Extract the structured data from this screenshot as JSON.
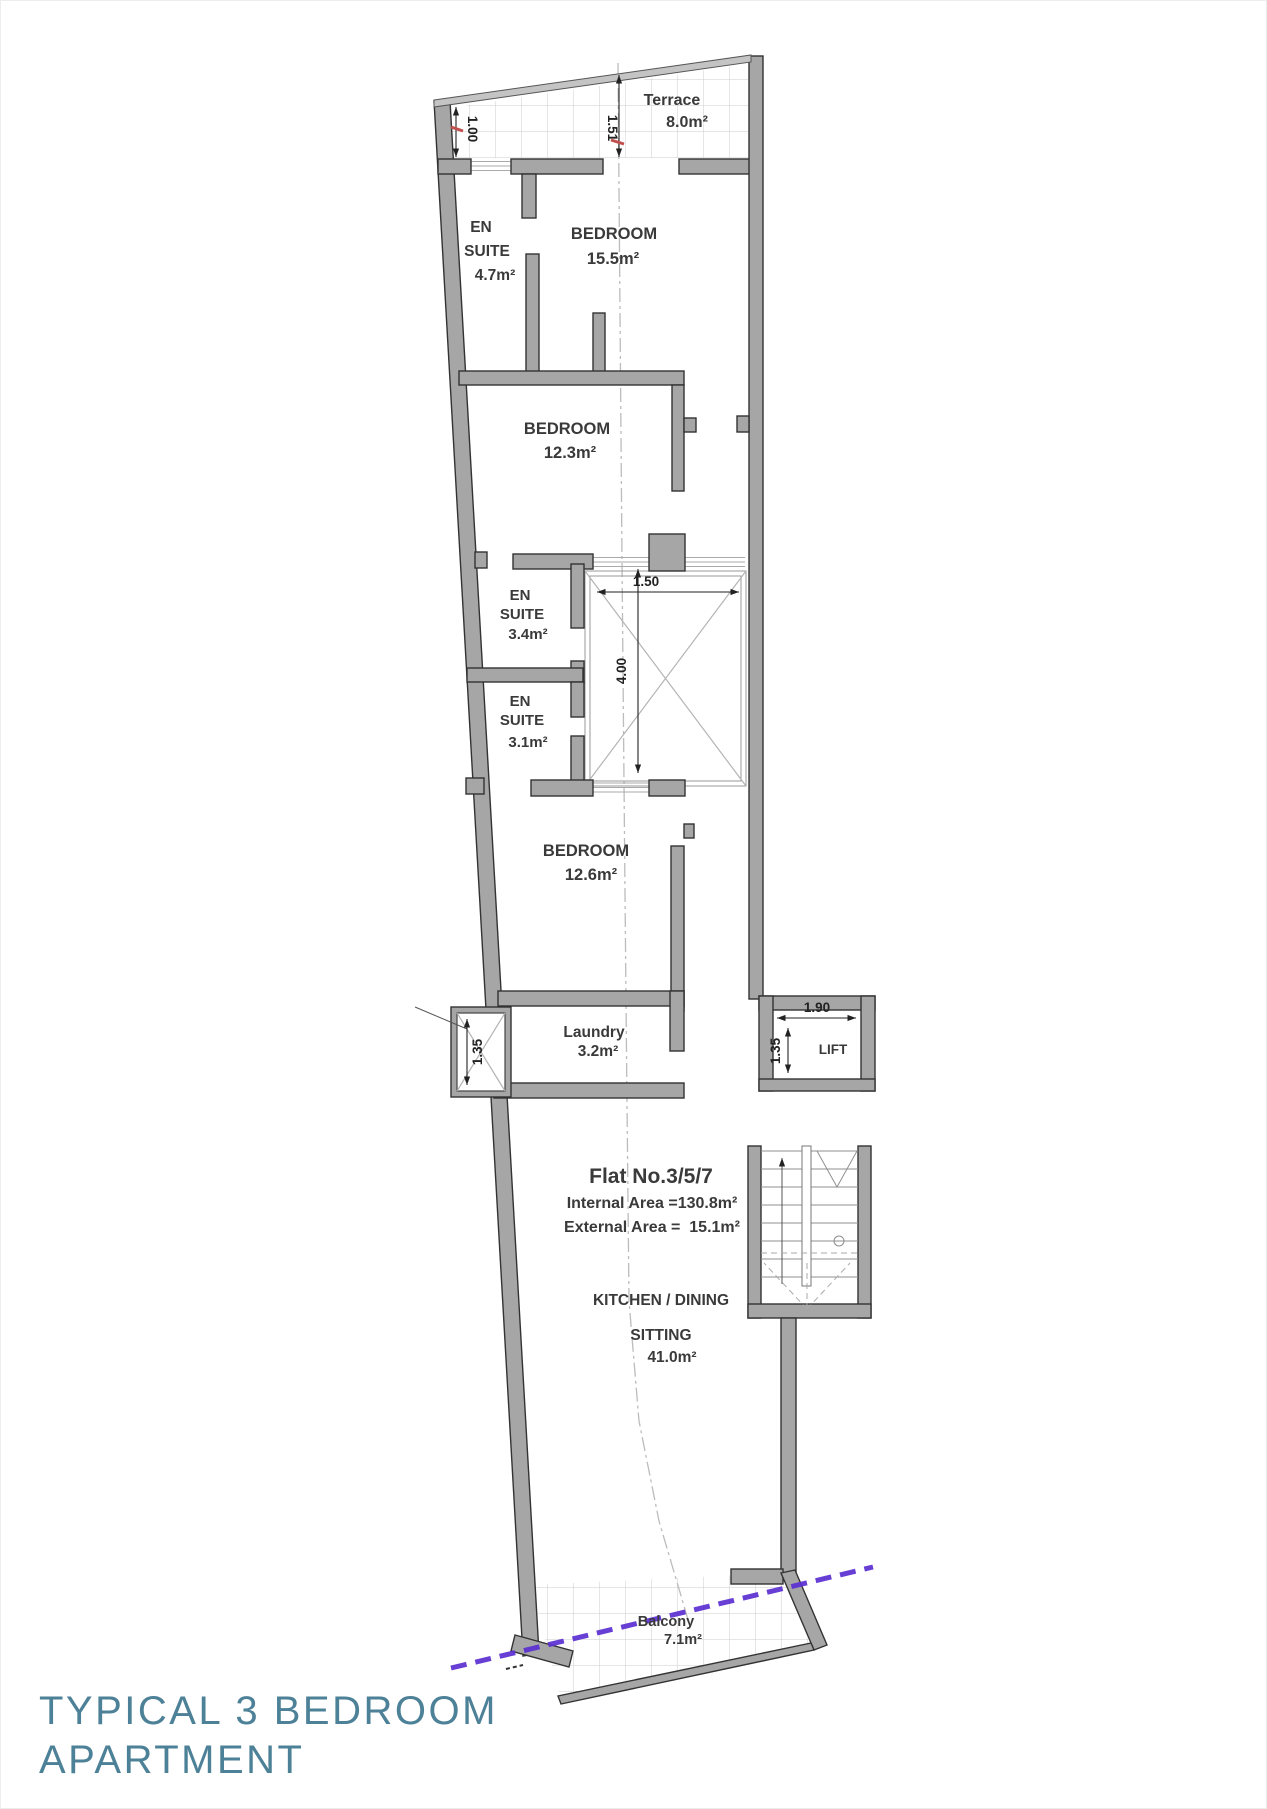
{
  "page": {
    "title_line1": "TYPICAL 3 BEDROOM",
    "title_line2": "APARTMENT"
  },
  "plan": {
    "flat": {
      "name": "Flat No.3/5/7",
      "internal": "Internal Area =130.8m²",
      "external": "External Area =  15.1m²"
    },
    "rooms": {
      "terrace": {
        "name": "Terrace",
        "area": "8.0m²"
      },
      "ensuite_1": {
        "l1": "EN",
        "l2": "SUITE",
        "area": "4.7m²"
      },
      "bedroom_1": {
        "name": "BEDROOM",
        "area": "15.5m²"
      },
      "bedroom_2": {
        "name": "BEDROOM",
        "area": "12.3m²"
      },
      "ensuite_2": {
        "l1": "EN",
        "l2": "SUITE",
        "area": "3.4m²"
      },
      "ensuite_3": {
        "l1": "EN",
        "l2": "SUITE",
        "area": "3.1m²"
      },
      "bedroom_3": {
        "name": "BEDROOM",
        "area": "12.6m²"
      },
      "laundry": {
        "name": "Laundry",
        "area": "3.2m²"
      },
      "lift": {
        "name": "LIFT"
      },
      "kitchen": {
        "l1": "KITCHEN / DINING",
        "l2": "SITTING",
        "area": "41.0m²"
      },
      "balcony": {
        "name": "Balcony",
        "area": "7.1m²"
      }
    },
    "dims": {
      "terrace_left": "1.00",
      "terrace_mid": "1.51",
      "shaft_w": "1.50",
      "shaft_h": "4.00",
      "laundry_shaft": "1.35",
      "lift_w": "1.90",
      "lift_h": "1.35"
    }
  },
  "colors": {
    "wall": "#a6a6a6",
    "wall_outline": "#333333",
    "tile_grid": "#cccccc",
    "centerline": "#bcbcbc",
    "boundary_line": "#5b2fd2",
    "red_tick": "#c0504d",
    "title": "#4d8197",
    "label": "#3a3a3a"
  }
}
